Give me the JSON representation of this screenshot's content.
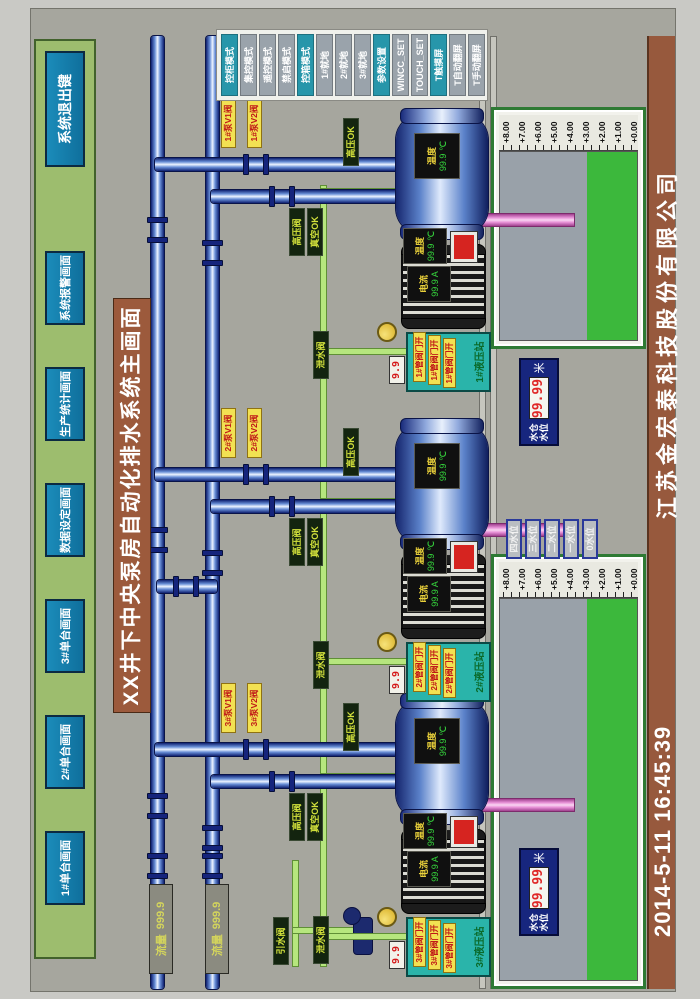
{
  "title": "XX井下中央泵房自动化排水系统主画面",
  "nav": {
    "buttons": [
      {
        "label": "1#单台画面"
      },
      {
        "label": "2#单台画面"
      },
      {
        "label": "3#单台画面"
      },
      {
        "label": "数据设定画面"
      },
      {
        "label": "生产统计画面"
      },
      {
        "label": "系统报警画面"
      }
    ],
    "exit_label": "系统退出键"
  },
  "mode_panel": {
    "buttons": [
      {
        "label": "控柜模式",
        "variant": "teal"
      },
      {
        "label": "集控模式",
        "variant": "gray"
      },
      {
        "label": "遥控模式",
        "variant": "gray"
      },
      {
        "label": "禁启模式",
        "variant": "gray"
      },
      {
        "label": "控箱模式",
        "variant": "teal"
      },
      {
        "label": "1#就地",
        "variant": "gray"
      },
      {
        "label": "2#就地",
        "variant": "gray"
      },
      {
        "label": "3#就地",
        "variant": "gray"
      },
      {
        "label": "参数设置",
        "variant": "teal"
      },
      {
        "label": "WINCC_SET",
        "variant": "gray"
      },
      {
        "label": "TOUCH_SET",
        "variant": "gray"
      },
      {
        "label": "T触摸屏",
        "variant": "teal"
      },
      {
        "label": "T自动翻屏",
        "variant": "gray"
      },
      {
        "label": "T手动翻屏",
        "variant": "gray"
      }
    ]
  },
  "flow_meters": [
    {
      "label": "流量",
      "value": "999.9"
    },
    {
      "label": "流量",
      "value": "999.9"
    }
  ],
  "units": [
    {
      "id": "3#",
      "valve_top": "3#泵V1阀",
      "valve_bottom": "3#泵V2阀",
      "pump_temp": {
        "label": "温度",
        "value": "99.9",
        "unit": "℃"
      },
      "motor_current": {
        "label": "电流",
        "value": "99.9",
        "unit": "A"
      },
      "motor_temp": {
        "label": "温度",
        "value": "99.9",
        "unit": "℃"
      },
      "tag_hp_ok": "高压OK",
      "tag_hp_valve": "高压阀",
      "tag_vac_ok": "真空OK",
      "tag_drain": "泄水阀",
      "gauge": "9.9",
      "station": {
        "title": "3#液压站",
        "tags": [
          "3#管阀门开",
          "3#管阀门开",
          "3#管阀门开"
        ]
      }
    },
    {
      "id": "2#",
      "valve_top": "2#泵V1阀",
      "valve_bottom": "2#泵V2阀",
      "pump_temp": {
        "label": "温度",
        "value": "99.9",
        "unit": "℃"
      },
      "motor_current": {
        "label": "电流",
        "value": "99.9",
        "unit": "A"
      },
      "motor_temp": {
        "label": "温度",
        "value": "99.9",
        "unit": "℃"
      },
      "tag_hp_ok": "高压OK",
      "tag_hp_valve": "高压阀",
      "tag_vac_ok": "真空OK",
      "tag_drain": "泄水阀",
      "gauge": "9.9",
      "station": {
        "title": "2#液压站",
        "tags": [
          "2#管阀门开",
          "2#管阀门开",
          "2#管阀门开"
        ]
      }
    },
    {
      "id": "1#",
      "valve_top": "1#泵V1阀",
      "valve_bottom": "1#泵V2阀",
      "pump_temp": {
        "label": "温度",
        "value": "99.9",
        "unit": "℃"
      },
      "motor_current": {
        "label": "电流",
        "value": "99.9",
        "unit": "A"
      },
      "motor_temp": {
        "label": "温度",
        "value": "99.9",
        "unit": "℃"
      },
      "tag_hp_ok": "高压OK",
      "tag_hp_valve": "高压阀",
      "tag_vac_ok": "真空OK",
      "tag_drain": "泄水阀",
      "gauge": "9.9",
      "station": {
        "title": "1#液压站",
        "tags": [
          "1#管阀门开",
          "1#管阀门开",
          "1#管阀门开"
        ]
      }
    }
  ],
  "jet_valve_label": "引水阀",
  "sumps": [
    {
      "scale": [
        "+8.00",
        "+7.00",
        "+6.00",
        "+5.00",
        "+4.00",
        "+3.00",
        "+2.00",
        "+1.00",
        "+0.00"
      ]
    },
    {
      "scale": [
        "+8.00",
        "+7.00",
        "+6.00",
        "+5.00",
        "+4.00",
        "+3.00",
        "+2.00",
        "+1.00",
        "+0.00"
      ]
    }
  ],
  "level_panels": [
    {
      "line1": "水仓",
      "line2": "水位",
      "value": "99.99",
      "unit": "米"
    },
    {
      "line1": "水仓",
      "line2": "水位",
      "value": "99.99",
      "unit": "米"
    }
  ],
  "level_buttons": [
    "四水位",
    "三水位",
    "二水位",
    "一水位",
    "0水位"
  ],
  "footer": {
    "datetime": "2014-5-11  16:45:39",
    "company": "江苏金宏泰科技股份有限公司"
  },
  "colors": {
    "accent_teal": "#2796aa",
    "pipe_blue": "#16307e",
    "alarm_red": "#d62420",
    "water_green": "#3cb83c",
    "panel_green": "#9dbd6e",
    "title_brown": "#9c5a3c"
  }
}
